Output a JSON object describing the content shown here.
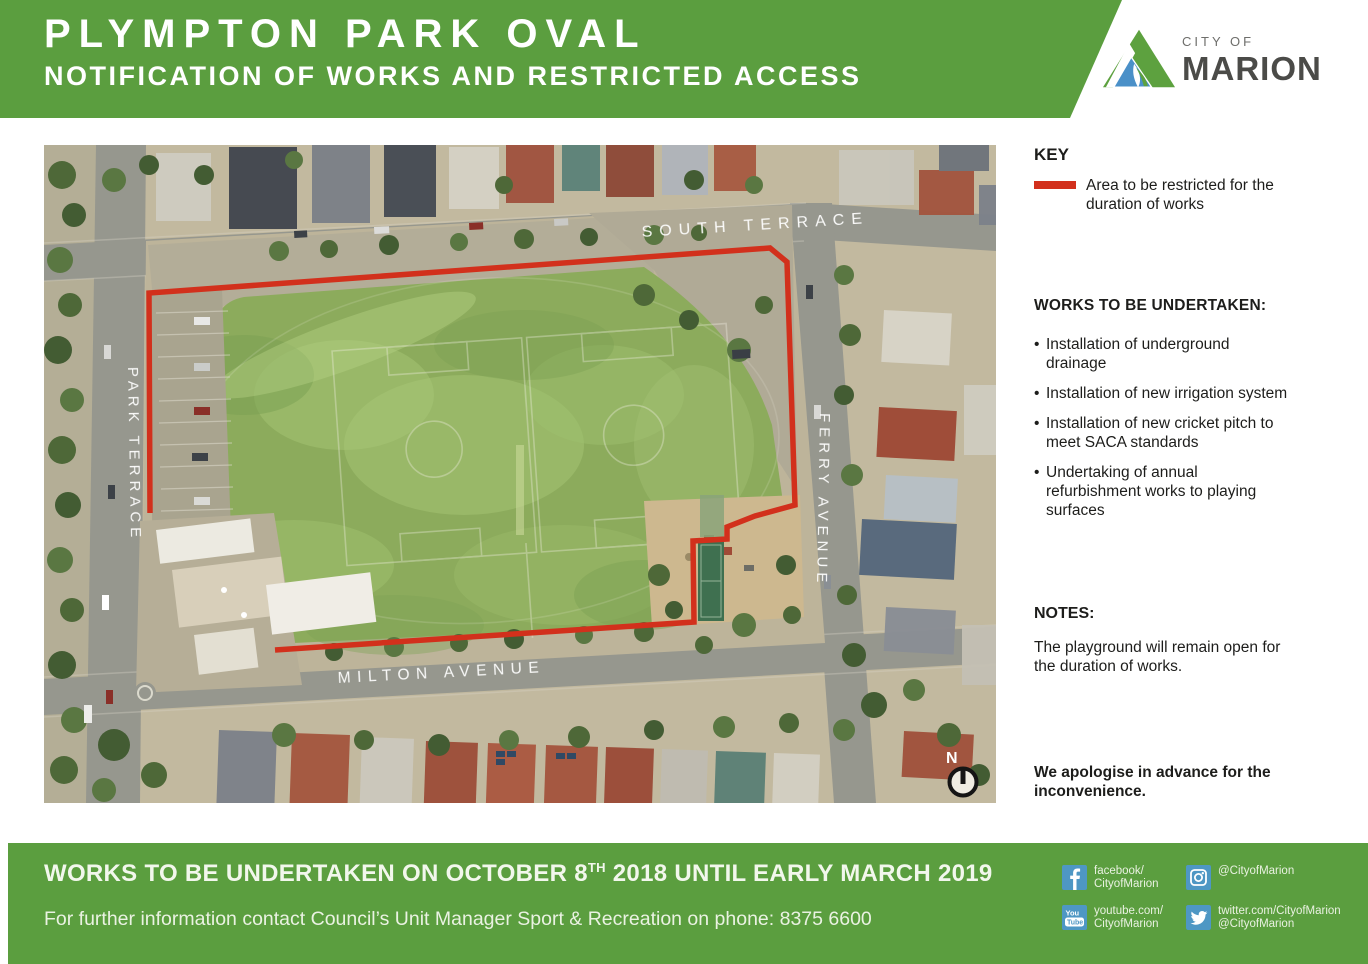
{
  "header": {
    "title": "PLYMPTON PARK OVAL",
    "subtitle": "NOTIFICATION OF WORKS AND RESTRICTED ACCESS"
  },
  "logo": {
    "city_of": "CITY OF",
    "name": "MARION"
  },
  "map": {
    "street_labels": {
      "top": "SOUTH TERRACE",
      "left": "PARK TERRACE",
      "right": "FERRY AVENUE",
      "bottom": "MILTON AVENUE"
    },
    "north_label": "N"
  },
  "key": {
    "heading": "KEY",
    "item": "Area to be restricted for the\nduration of works"
  },
  "works": {
    "heading": "WORKS TO BE UNDERTAKEN:",
    "bullet": "•",
    "items": [
      "Installation of underground\ndrainage",
      "Installation of new irrigation system",
      "Installation of new cricket pitch to\nmeet SACA standards",
      "Undertaking of annual\nrefurbishment works to playing\nsurfaces"
    ]
  },
  "notes": {
    "heading": "NOTES:",
    "body": "The playground will remain open for\nthe duration of works."
  },
  "apology": "We apologise in advance for the\ninconvenience.",
  "footer": {
    "headline_prefix": "WORKS TO BE UNDERTAKEN ON OCTOBER 8",
    "headline_sup": "TH",
    "headline_suffix": " 2018 UNTIL EARLY MARCH 2019",
    "info": "For further information contact Council’s Unit Manager Sport & Recreation on phone: 8375 6600",
    "phone": "8375 6600",
    "social": [
      {
        "name": "facebook",
        "label": "facebook/\nCityofMarion"
      },
      {
        "name": "instagram",
        "label": "@CityofMarion"
      },
      {
        "name": "youtube",
        "label": "youtube.com/\nCityofMarion"
      },
      {
        "name": "twitter",
        "label": "twitter.com/CityofMarion\n@CityofMarion"
      }
    ]
  },
  "colors": {
    "brand_green": "#5b9e3f",
    "restricted_red": "#d2301c",
    "social_blue": "#4e97c4",
    "logo_blue": "#4a90c8",
    "logo_green": "#5da13f",
    "text_dark": "#1d1d1b"
  }
}
